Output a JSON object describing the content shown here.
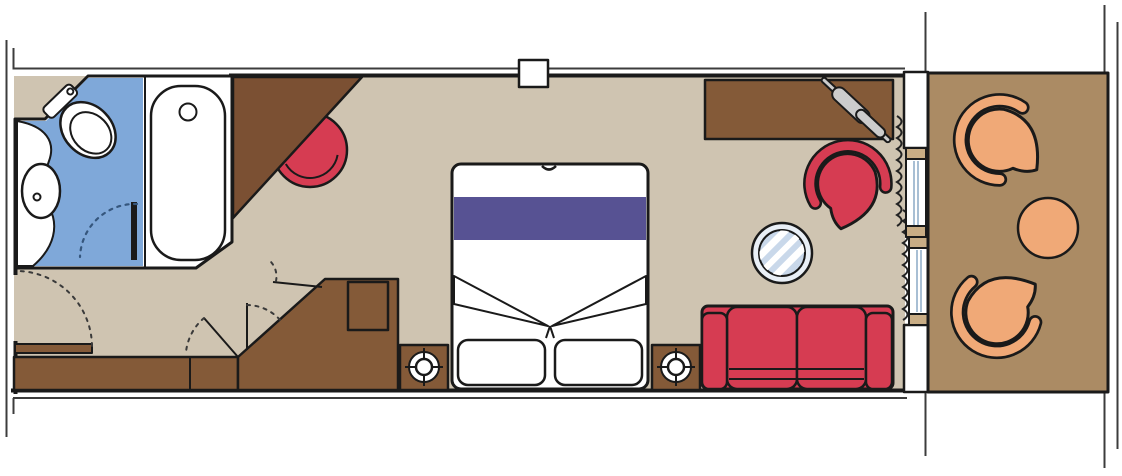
{
  "meta": {
    "title": "Cruise ship cabin floor plan with private balcony",
    "diagram_type": "architectural top-view floor plan",
    "has_text": false
  },
  "colors": {
    "wall_black": "#1a1a1a",
    "corridor_line": "#3c3c3c",
    "cabin_floor": "#cfc4b1",
    "balcony_floor": "#ab8b64",
    "bathroom_floor": "#7fa8d9",
    "wood": "#845a38",
    "wood_dark": "#7b5033",
    "upholstery_red": "#d63c52",
    "bed_runner_purple": "#575293",
    "balcony_orange": "#f0a977",
    "glass_light": "#e9eff6",
    "glass_mid": "#c9d8ea",
    "window_frame_tan": "#c9ad85",
    "metal_gray": "#cccccc",
    "white": "#ffffff",
    "arrow_brown": "#3a2a18"
  },
  "rooms": [
    {
      "id": "bathroom",
      "label": "Bathroom",
      "floor_color_ref": "bathroom_floor",
      "fixtures": [
        "vanity counter with washbasin",
        "toilet",
        "bathtub",
        "inward-swinging door"
      ]
    },
    {
      "id": "cabin",
      "label": "Cabin / bedroom area",
      "floor_color_ref": "cabin_floor",
      "furniture": [
        "corner wardrobe (triangular)",
        "red stool",
        "wardrobe with safe",
        "low cabinet strip",
        "entry door with swing arc",
        "double bed with purple runner and two pillows",
        "two nightstands with lamps",
        "red two-seat sofa",
        "desk with hairdryer",
        "red shell armchair",
        "round glass table",
        "curtains at window wall"
      ]
    },
    {
      "id": "balcony",
      "label": "Private balcony",
      "floor_color_ref": "balcony_floor",
      "furniture": [
        "two orange shell chairs",
        "round orange table"
      ]
    }
  ],
  "structure": {
    "corridor_side": "thin reference lines at top, left and bottom (neighbouring cabins / corridor)",
    "column": "small square structural column interrupting the top wall",
    "window_wall": [
      "fixed glass panel",
      "sliding balcony door",
      "slide-direction arrow on balcony side"
    ],
    "balcony_partitions": "thin partition lines extending beyond balcony slab on both sides",
    "door_swings": 4
  },
  "items": [
    {
      "id": "washbasin",
      "room": "bathroom",
      "color_ref": "white",
      "count": 1
    },
    {
      "id": "toilet",
      "room": "bathroom",
      "color_ref": "white",
      "count": 1
    },
    {
      "id": "bathtub",
      "room": "bathroom",
      "color_ref": "white",
      "count": 1
    },
    {
      "id": "bathroom-door",
      "room": "bathroom",
      "color_ref": "wall_black",
      "count": 1
    },
    {
      "id": "corner-wardrobe",
      "room": "cabin",
      "color_ref": "wood_dark",
      "count": 1
    },
    {
      "id": "stool",
      "room": "cabin",
      "color_ref": "upholstery_red",
      "count": 1
    },
    {
      "id": "wardrobe",
      "room": "cabin",
      "color_ref": "wood",
      "count": 1
    },
    {
      "id": "safe",
      "room": "cabin",
      "color_ref": "wood",
      "count": 1
    },
    {
      "id": "low-cabinet",
      "room": "cabin",
      "color_ref": "wood",
      "count": 1
    },
    {
      "id": "entry-door",
      "room": "cabin",
      "color_ref": "wood",
      "count": 1
    },
    {
      "id": "double-bed",
      "room": "cabin",
      "color_ref": "white",
      "count": 1
    },
    {
      "id": "bed-runner",
      "room": "cabin",
      "color_ref": "bed_runner_purple",
      "count": 1
    },
    {
      "id": "pillow",
      "room": "cabin",
      "color_ref": "white",
      "count": 2
    },
    {
      "id": "nightstand",
      "room": "cabin",
      "color_ref": "wood",
      "count": 2
    },
    {
      "id": "lamp",
      "room": "cabin",
      "color_ref": "white",
      "count": 2
    },
    {
      "id": "sofa",
      "room": "cabin",
      "color_ref": "upholstery_red",
      "count": 1
    },
    {
      "id": "desk",
      "room": "cabin",
      "color_ref": "wood",
      "count": 1
    },
    {
      "id": "hairdryer",
      "room": "cabin",
      "color_ref": "metal_gray",
      "count": 1
    },
    {
      "id": "armchair",
      "room": "cabin",
      "color_ref": "upholstery_red",
      "count": 1
    },
    {
      "id": "glass-table",
      "room": "cabin",
      "color_ref": "glass_mid",
      "count": 1
    },
    {
      "id": "curtain",
      "room": "cabin",
      "color_ref": "wall_black",
      "count": 2
    },
    {
      "id": "fixed-window",
      "room": "cabin",
      "color_ref": "window_frame_tan",
      "count": 1
    },
    {
      "id": "sliding-door",
      "room": "cabin",
      "color_ref": "window_frame_tan",
      "count": 1
    },
    {
      "id": "balcony-chair",
      "room": "balcony",
      "color_ref": "balcony_orange",
      "count": 2
    },
    {
      "id": "balcony-table",
      "room": "balcony",
      "color_ref": "balcony_orange",
      "count": 1
    }
  ]
}
